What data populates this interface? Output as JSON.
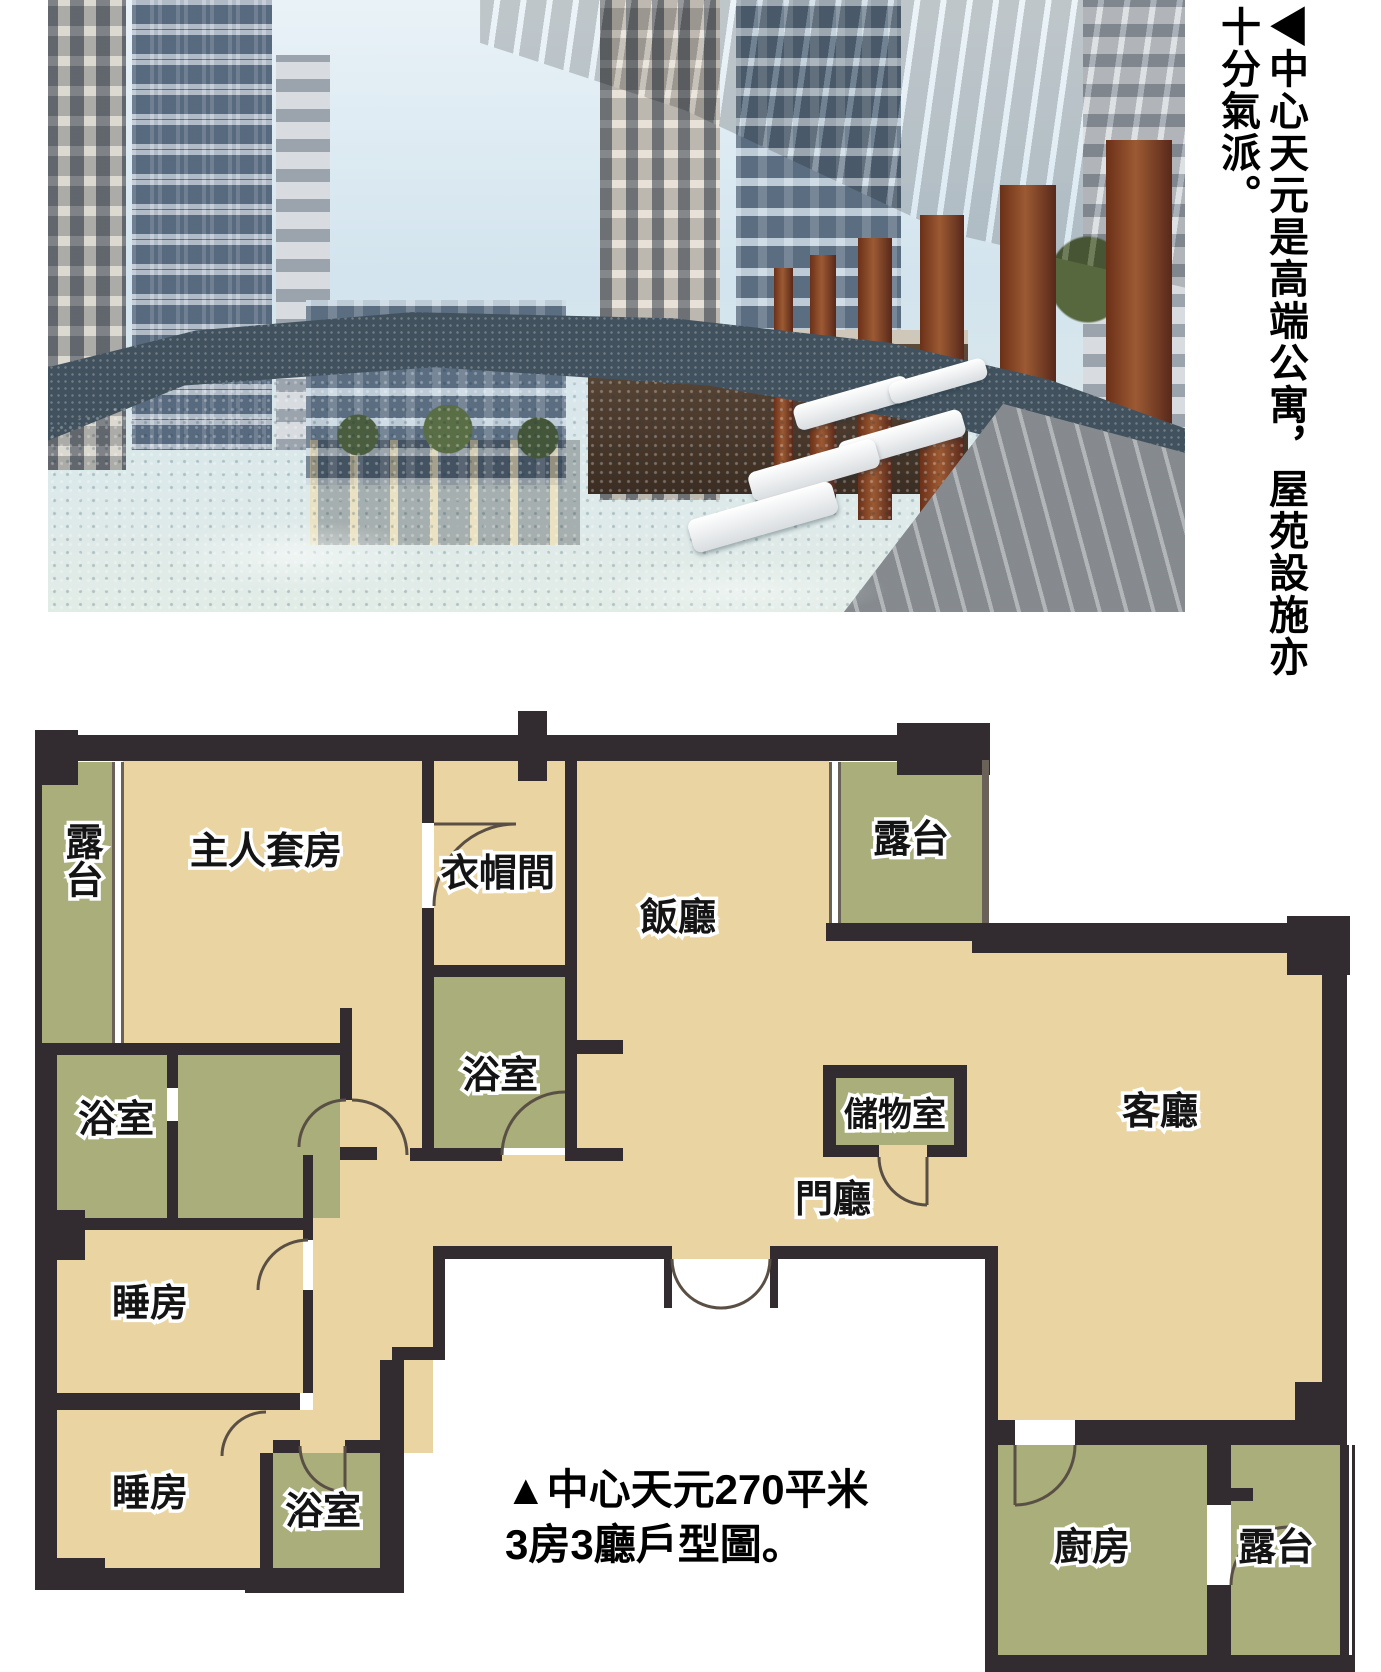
{
  "photo_caption": {
    "line1": "◀中心天元是高端公寓，屋苑設施亦",
    "line2": "十分氣派。"
  },
  "plan_caption": {
    "line1": "▲中心天元270平米",
    "line2": "3房3廳戶型圖。"
  },
  "plan": {
    "labels": {
      "balcony": "露台",
      "master_suite": "主人套房",
      "closet": "衣帽間",
      "dining": "飯廳",
      "bath": "浴室",
      "storage": "儲物室",
      "foyer": "門廳",
      "living": "客廳",
      "bedroom": "睡房",
      "kitchen": "廚房"
    },
    "colors": {
      "wall": "#322c31",
      "room_dry": "#e9d4a2",
      "room_wet": "#a9ae7b",
      "label_fill": "#141414",
      "label_outline": "#ffffff"
    }
  },
  "photo": {
    "scene": "infinity-pool courtyard between high-rise apartment towers, rust-red pergola columns and dark canopy on right, white loungers on pool edge",
    "colors": {
      "pool": "#45aebb",
      "mosaic_edge": "#41525e",
      "columns": "#8a4a2c",
      "canopy": "#565b63",
      "sky": "#d3e4ee"
    }
  }
}
